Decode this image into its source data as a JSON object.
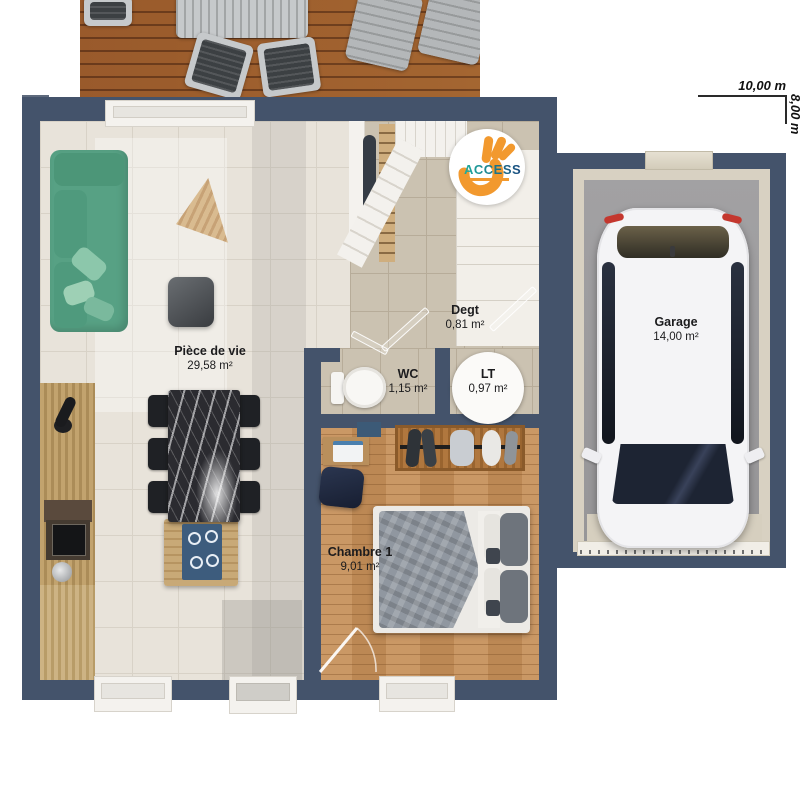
{
  "plan": {
    "dimensions": {
      "width": "10,00 m",
      "height": "8,00 m"
    },
    "logo": {
      "name": "ACCESS"
    },
    "rooms": [
      {
        "name": "Pièce de vie",
        "area": "29,58 m²"
      },
      {
        "name": "Degt",
        "area": "0,81 m²"
      },
      {
        "name": "WC",
        "area": "1,15 m²"
      },
      {
        "name": "LT",
        "area": "0,97 m²"
      },
      {
        "name": "Chambre 1",
        "area": "9,01 m²"
      },
      {
        "name": "Garage",
        "area": "14,00 m²"
      }
    ]
  },
  "colors": {
    "wall": "#44536b",
    "logo_orange": "#f2992e",
    "logo_text_start": "#1fae9e",
    "logo_text_end": "#17497e",
    "sofa_green": "#57a184",
    "wood_floor": "#c68f58"
  }
}
